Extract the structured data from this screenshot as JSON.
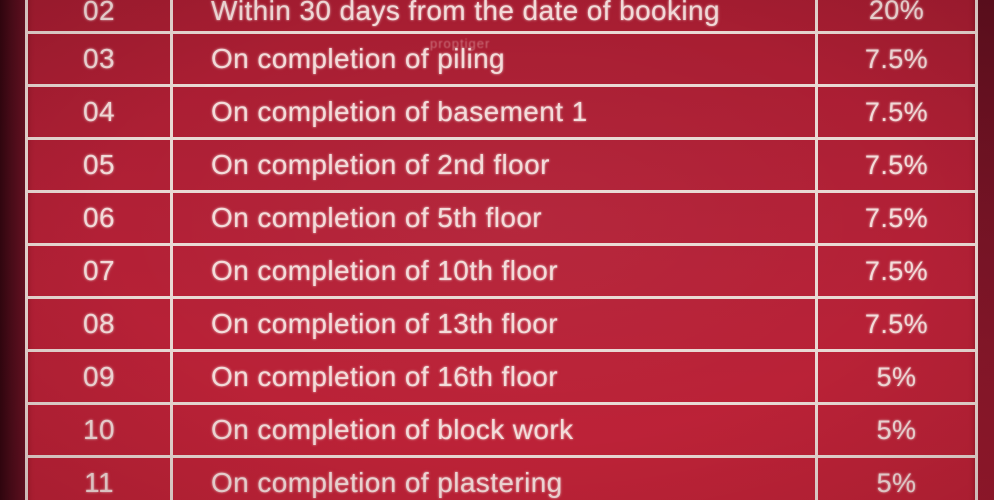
{
  "document": {
    "type": "payment-schedule-table",
    "visible_serial_range": "02–11"
  },
  "watermark": {
    "text": "proptiger"
  },
  "table": {
    "columns": [
      "serial_no",
      "milestone",
      "percentage"
    ],
    "rows": [
      {
        "no": "02",
        "milestone": "Within 30 days from the date of booking",
        "pct": "20%"
      },
      {
        "no": "03",
        "milestone": "On completion of piling",
        "pct": "7.5%"
      },
      {
        "no": "04",
        "milestone": "On completion of basement 1",
        "pct": "7.5%"
      },
      {
        "no": "05",
        "milestone": "On completion of 2nd floor",
        "pct": "7.5%"
      },
      {
        "no": "06",
        "milestone": "On completion of 5th floor",
        "pct": "7.5%"
      },
      {
        "no": "07",
        "milestone": "On completion of 10th floor",
        "pct": "7.5%"
      },
      {
        "no": "08",
        "milestone": "On completion of 13th floor",
        "pct": "7.5%"
      },
      {
        "no": "09",
        "milestone": "On completion of 16th floor",
        "pct": "5%"
      },
      {
        "no": "10",
        "milestone": "On completion of block work",
        "pct": "5%"
      },
      {
        "no": "11",
        "milestone": "On completion of plastering",
        "pct": "5%"
      }
    ]
  },
  "colors": {
    "cell_red": "#b22036",
    "grid_line": "#e9d9d4",
    "text_pink": "#f3dcda",
    "left_strip": "#4a0c19",
    "right_strip": "#7c1527"
  }
}
